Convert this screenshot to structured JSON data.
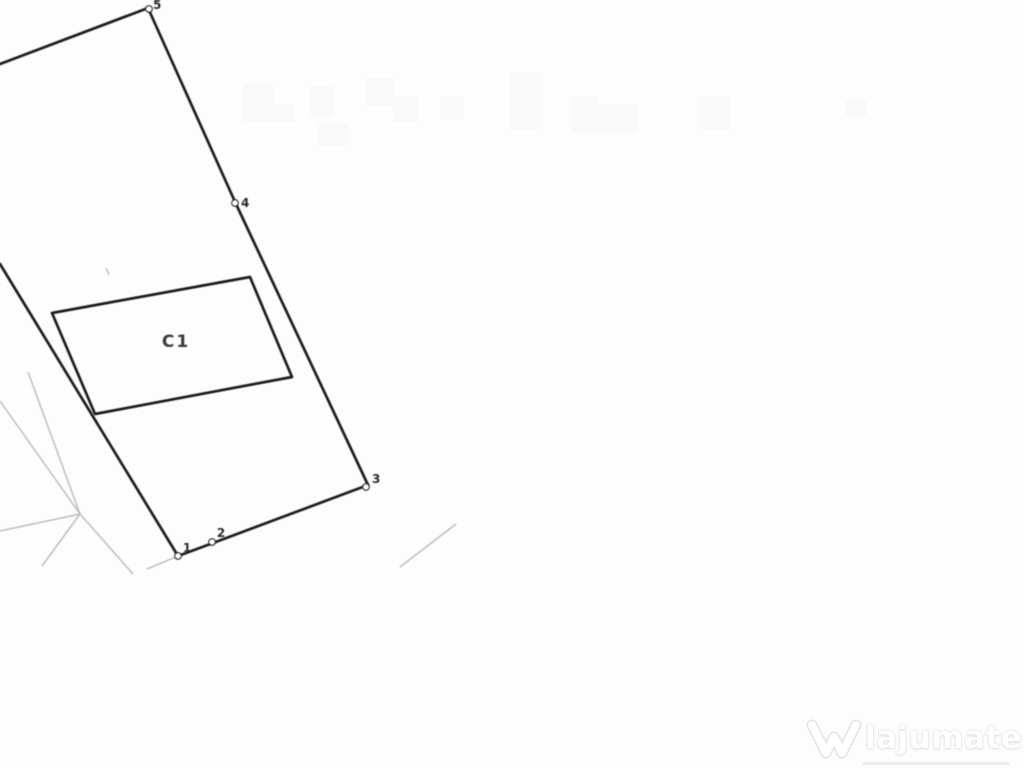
{
  "plan": {
    "building_label": "C1",
    "points": [
      {
        "label": "1"
      },
      {
        "label": "2"
      },
      {
        "label": "3"
      },
      {
        "label": "4"
      },
      {
        "label": "5"
      }
    ]
  },
  "watermark": {
    "brand": "lajumate",
    "tld": ".ro",
    "accent_color": "#9ccdbb"
  },
  "colors": {
    "ink": "#1f1f1f",
    "faint_line": "#bdbdbd",
    "paper": "#fdfdfd",
    "label_ink": "#3a3a3a"
  }
}
